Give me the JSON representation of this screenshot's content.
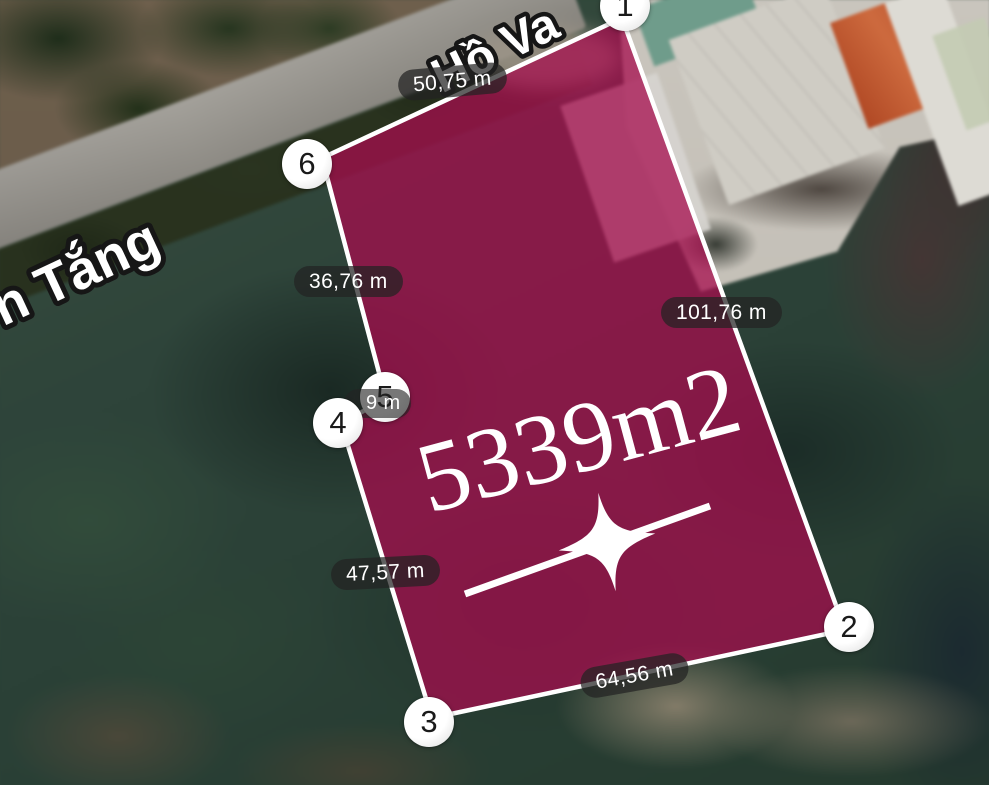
{
  "map": {
    "area_label": "5339m2",
    "street_label_top": "Hồ Va",
    "street_label_left": "n Tắng",
    "markers": [
      {
        "label": "1"
      },
      {
        "label": "2"
      },
      {
        "label": "3"
      },
      {
        "label": "4"
      },
      {
        "label": "5"
      },
      {
        "label": "6"
      }
    ],
    "measurements": {
      "edge_6_1": "50,75 m",
      "edge_5_6": "36,76 m",
      "edge_1_2": "101,76 m",
      "edge_4_5": "9 m",
      "edge_3_4": "47,57 m",
      "edge_2_3": "64,56 m"
    },
    "colors": {
      "plot_fill": "#a50d4d",
      "plot_border": "#ffffff",
      "pill_bg": "rgba(35,35,35,0.72)",
      "pill_text": "#ffffff",
      "marker_bg": "#ffffff",
      "marker_text": "#1a1a1a",
      "street_text": "#ffffff",
      "street_outline": "#161616",
      "area_text": "#ffffff",
      "road": "#93908a"
    }
  }
}
